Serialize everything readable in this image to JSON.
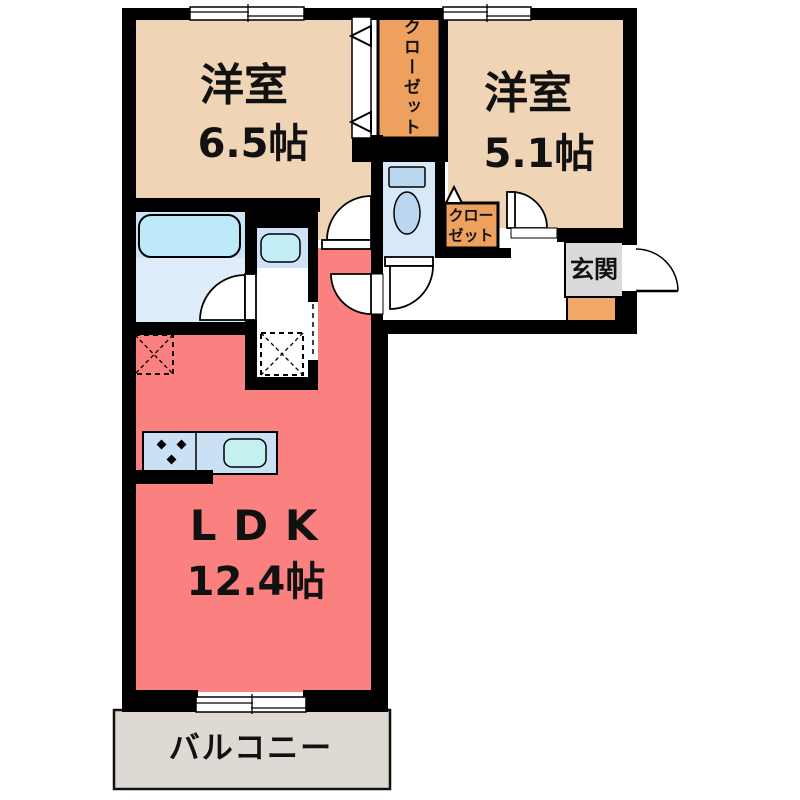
{
  "floor_plan": {
    "bedroom1": {
      "label": "洋室",
      "size": "6.5帖"
    },
    "bedroom2": {
      "label": "洋室",
      "size": "5.1帖"
    },
    "ldk": {
      "label": "LDK",
      "size": "12.4帖"
    },
    "closet_main": {
      "label": "クローゼット"
    },
    "closet_small": {
      "line1": "クロー",
      "line2": "ゼット"
    },
    "entrance": {
      "label": "玄関"
    },
    "balcony": {
      "label": "バルコニー"
    },
    "colors": {
      "wall": "#000000",
      "bedroom_floor": "#F0D4B6",
      "ldk_floor": "#FB8181",
      "closet": "#EEA05F",
      "shoe_cabinet": "#F2A869",
      "entrance_floor": "#DADADA",
      "balcony_floor": "#DEDAD3",
      "bath_floor_upper": "#CCE3F6",
      "bath_floor_lower": "#DFECFA",
      "bathtub": "#BEE9F8",
      "toilet_floor": "#D7E8F8",
      "fixture_blue": "#BBD7F0",
      "sink_cyan": "#C2EDF6",
      "kitchen_counter": "#C9E0F5",
      "kitchen_sink": "#C4F0EF"
    }
  }
}
